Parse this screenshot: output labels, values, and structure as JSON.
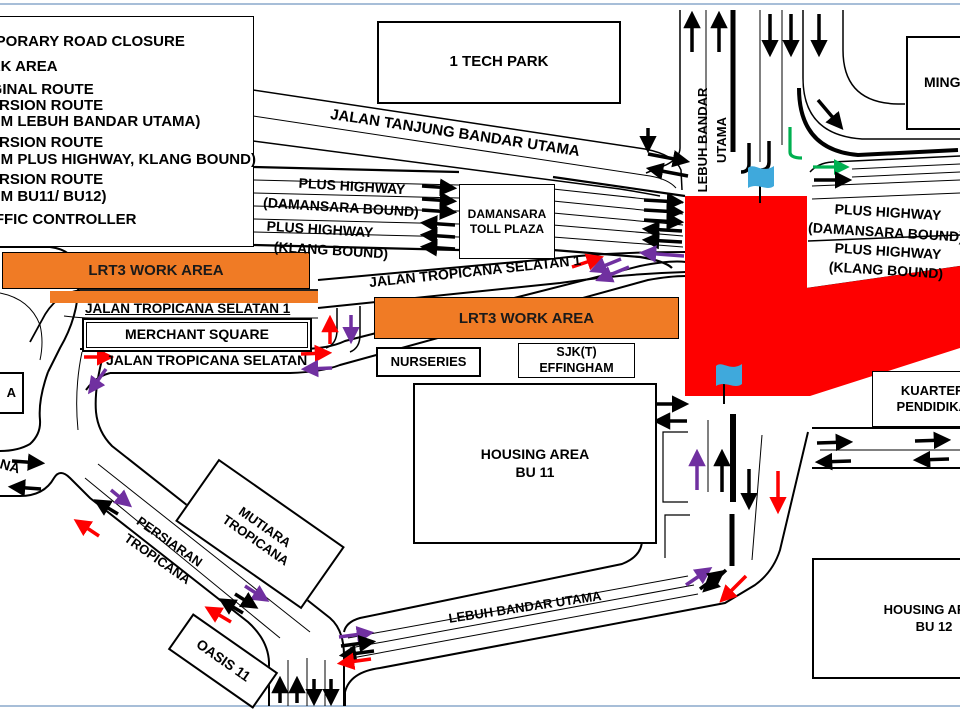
{
  "colors": {
    "work_area_orange": "#f07b25",
    "closure_red": "#fe0000",
    "diversion_purple": "#7030a0",
    "diversion_green": "#00b050",
    "flag_blue": "#3fa9dc",
    "slide_border_blue": "#a7bed8",
    "road_black": "#000000"
  },
  "legend": {
    "lines": [
      "TEMPORARY ROAD CLOSURE",
      "WORK AREA",
      "ORIGINAL ROUTE",
      "DIVERSION ROUTE",
      "(FROM LEBUH BANDAR UTAMA)",
      "DIVERSION ROUTE",
      "(FROM PLUS HIGHWAY, KLANG BOUND)",
      "DIVERSION ROUTE",
      "(FROM BU11/ BU12)",
      "TRAFFIC CONTROLLER"
    ]
  },
  "work_area_label": "LRT3 WORK AREA",
  "places": {
    "tech_park": "1 TECH PARK",
    "toll_plaza_line1": "DAMANSARA",
    "toll_plaza_line2": "TOLL PLAZA",
    "merchant_square": "MERCHANT SQUARE",
    "nurseries": "NURSERIES",
    "sjk_line1": "SJK(T)",
    "sjk_line2": "EFFINGHAM",
    "housing_bu11_line1": "HOUSING AREA",
    "housing_bu11_line2": "BU 11",
    "housing_bu12_line1": "HOUSING AREA",
    "housing_bu12_line2": "BU 12",
    "kuarters_line1": "KUARTERS",
    "kuarters_line2": "PENDIDIKAN",
    "ming": "MING",
    "mutiara_line1": "MUTIARA",
    "mutiara_line2": "TROPICANA",
    "oasis": "OASIS 11",
    "box_a": "A"
  },
  "roads": {
    "jalan_tanjung": "JALAN TANJUNG BANDAR UTAMA",
    "plus_highway": "PLUS HIGHWAY",
    "damansara_bound": "(DAMANSARA BOUND)",
    "klang_bound": "(KLANG BOUND)",
    "lebuh_line1": "LEBUH BANDAR",
    "lebuh_line2": "UTAMA",
    "jts1": "JALAN TROPICANA SELATAN 1",
    "jts": "JALAN TROPICANA SELATAN",
    "lebuh_bottom": "LEBUH BANDAR UTAMA",
    "persiaran_line1": "PERSIARAN",
    "persiaran_line2": "TROPICANA",
    "na_fragment": "NA"
  }
}
